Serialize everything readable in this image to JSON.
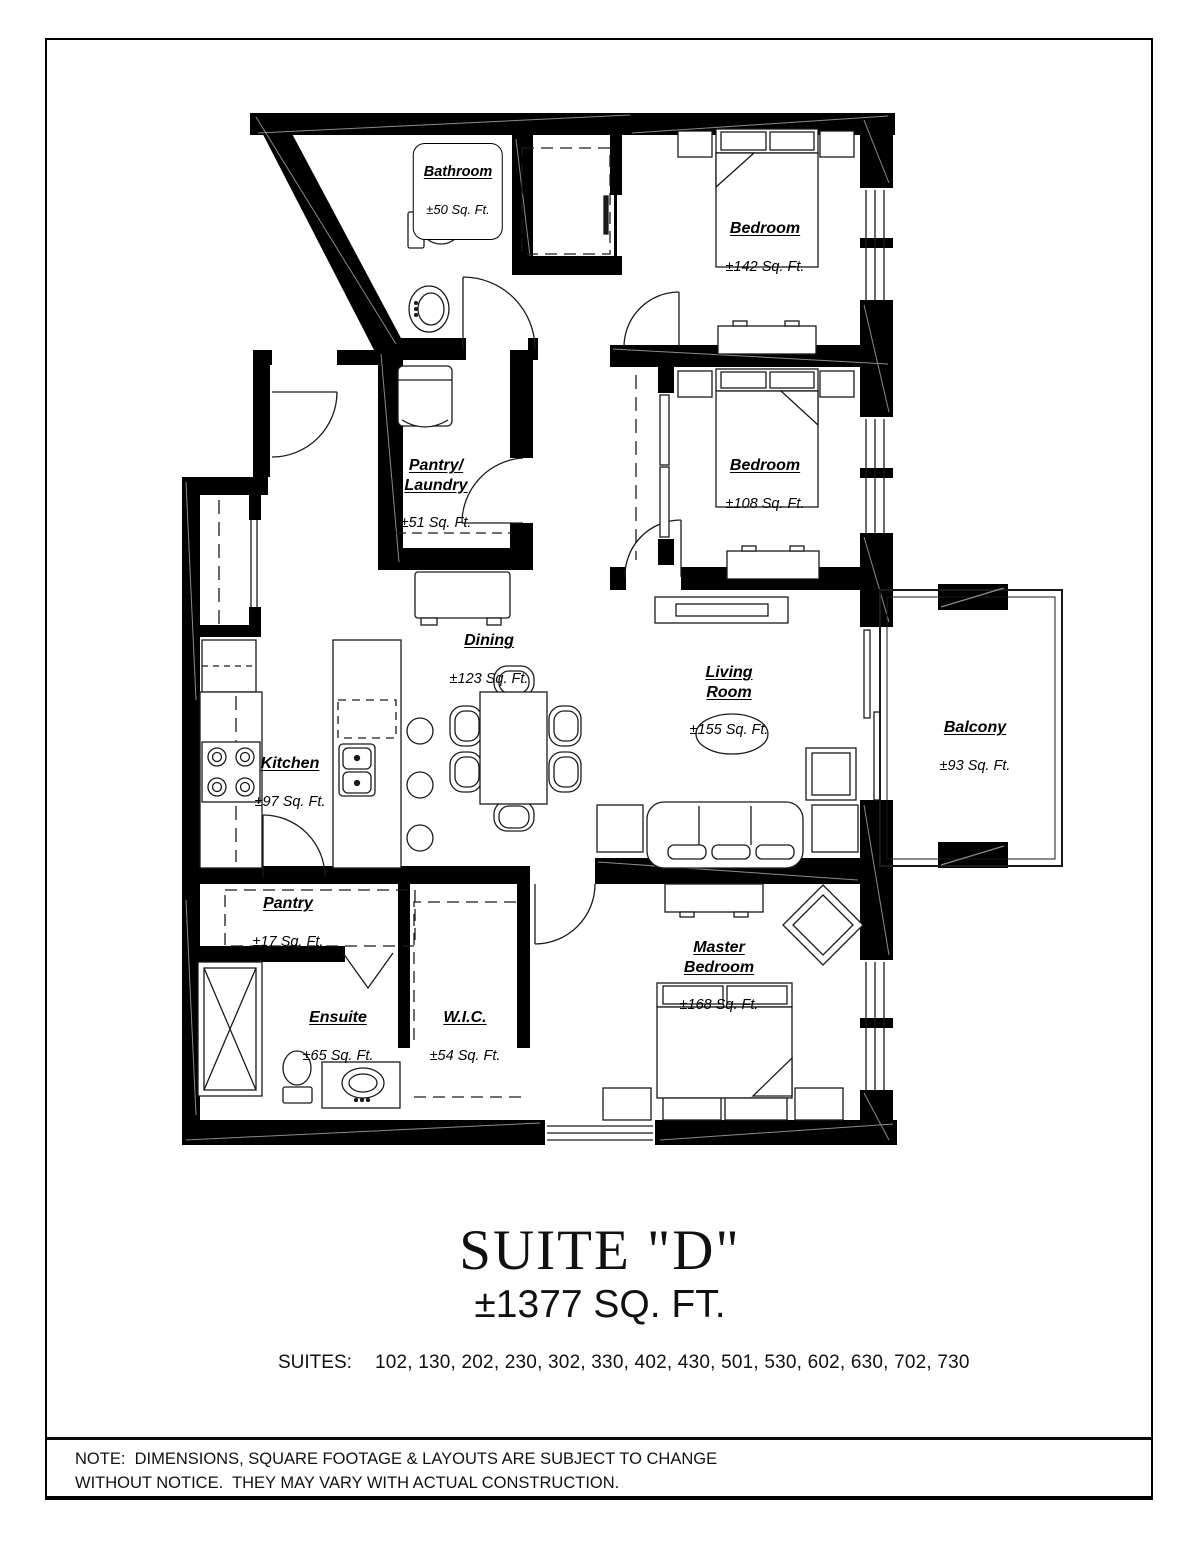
{
  "rooms": [
    {
      "id": "bathroom",
      "name": "Bathroom",
      "area": "±50 Sq. Ft."
    },
    {
      "id": "bedroom-1",
      "name": "Bedroom",
      "area": "±142 Sq. Ft."
    },
    {
      "id": "pantry-laundry",
      "name": "Pantry/\nLaundry",
      "area": "±51 Sq. Ft."
    },
    {
      "id": "bedroom-2",
      "name": "Bedroom",
      "area": "±108 Sq. Ft."
    },
    {
      "id": "dining",
      "name": "Dining",
      "area": "±123 Sq. Ft."
    },
    {
      "id": "living-room",
      "name": "Living\nRoom",
      "area": "±155 Sq. Ft."
    },
    {
      "id": "balcony",
      "name": "Balcony",
      "area": "±93 Sq. Ft."
    },
    {
      "id": "kitchen",
      "name": "Kitchen",
      "area": "±97 Sq. Ft."
    },
    {
      "id": "pantry",
      "name": "Pantry",
      "area": "±17 Sq. Ft."
    },
    {
      "id": "ensuite",
      "name": "Ensuite",
      "area": "±65 Sq. Ft."
    },
    {
      "id": "wic",
      "name": "W.I.C.",
      "area": "±54 Sq. Ft."
    },
    {
      "id": "master-bedroom",
      "name": "Master\nBedroom",
      "area": "±168 Sq. Ft."
    }
  ],
  "title_block": {
    "suite_name": "SUITE \"D\"",
    "total_area": "±1377 SQ. FT."
  },
  "suites": {
    "label": "SUITES:",
    "numbers": "102, 130, 202, 230, 302, 330, 402, 430, 501, 530, 602, 630, 702, 730"
  },
  "note": {
    "line1": "NOTE:  DIMENSIONS, SQUARE FOOTAGE & LAYOUTS ARE SUBJECT TO CHANGE",
    "line2": "WITHOUT NOTICE.  THEY MAY VARY WITH ACTUAL CONSTRUCTION."
  },
  "colors": {
    "wall": "#000000",
    "line": "#1a1a1a",
    "paper": "#ffffff"
  }
}
